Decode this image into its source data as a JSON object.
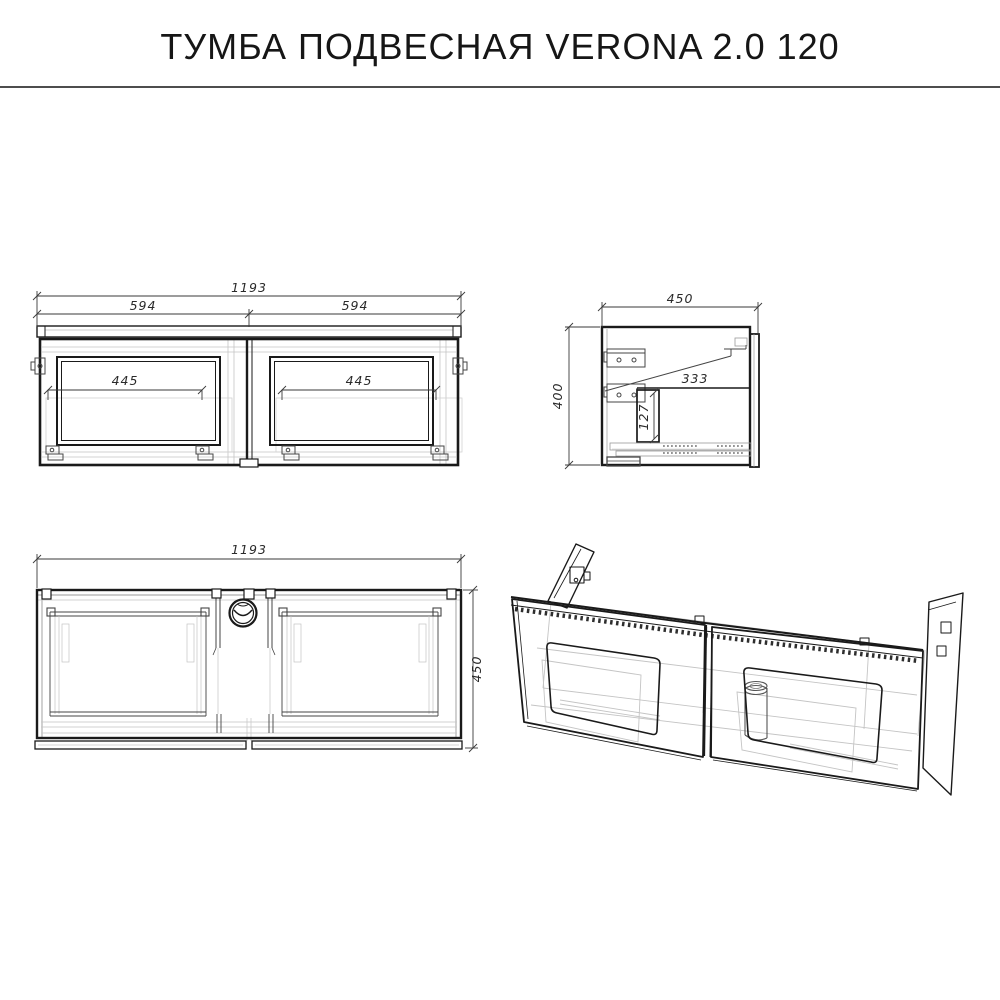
{
  "title": "ТУМБА ПОДВЕСНАЯ VERONA 2.0 120",
  "colors": {
    "ink": "#1a1a1a",
    "light_line": "#c4c4c4",
    "divider": "#4d4d4d"
  },
  "views": {
    "front": {
      "total_width": "1193",
      "left_section_width": "594",
      "right_section_width": "594",
      "left_opening_width": "445",
      "right_opening_width": "445"
    },
    "side": {
      "depth": "450",
      "height": "400",
      "inner_depth": "333",
      "drawer_height": "127"
    },
    "top": {
      "total_width": "1193",
      "depth": "450"
    }
  }
}
